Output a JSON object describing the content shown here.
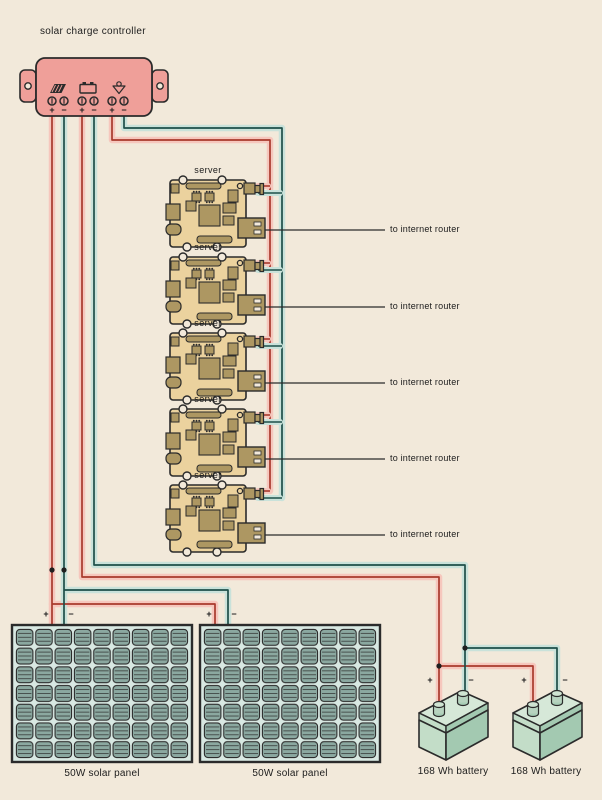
{
  "diagram_title": "solar charge controller",
  "controller": {
    "title": "solar charge controller",
    "terminals": [
      "+",
      "−",
      "+",
      "−",
      "+",
      "−"
    ],
    "icons": [
      "solar-panel-icon",
      "battery-icon",
      "lamp-icon"
    ]
  },
  "servers": [
    {
      "label": "server",
      "router_label": "to internet router"
    },
    {
      "label": "server",
      "router_label": "to internet router"
    },
    {
      "label": "server",
      "router_label": "to internet router"
    },
    {
      "label": "server",
      "router_label": "to internet router"
    },
    {
      "label": "server",
      "router_label": "to internet router"
    }
  ],
  "panels": [
    {
      "label": "50W solar panel",
      "plus": "+",
      "minus": "−"
    },
    {
      "label": "50W solar panel",
      "plus": "+",
      "minus": "−"
    }
  ],
  "batteries": [
    {
      "label": "168 Wh battery",
      "plus": "+",
      "minus": "−"
    },
    {
      "label": "168 Wh battery",
      "plus": "+",
      "minus": "−"
    }
  ],
  "colors": {
    "background": "#f2e9da",
    "wire_positive": "#a93a2d",
    "wire_positive_glow": "#f6c7bd",
    "wire_negative": "#1e4f49",
    "wire_negative_glow": "#c9e2da",
    "ethernet_line": "#2b2b2b",
    "controller_body": "#ef9f99",
    "server_board": "#ebd29e",
    "server_component": "#ad9762",
    "panel_cell": "#8ba8a0",
    "battery_body": "#c3ddc8"
  }
}
